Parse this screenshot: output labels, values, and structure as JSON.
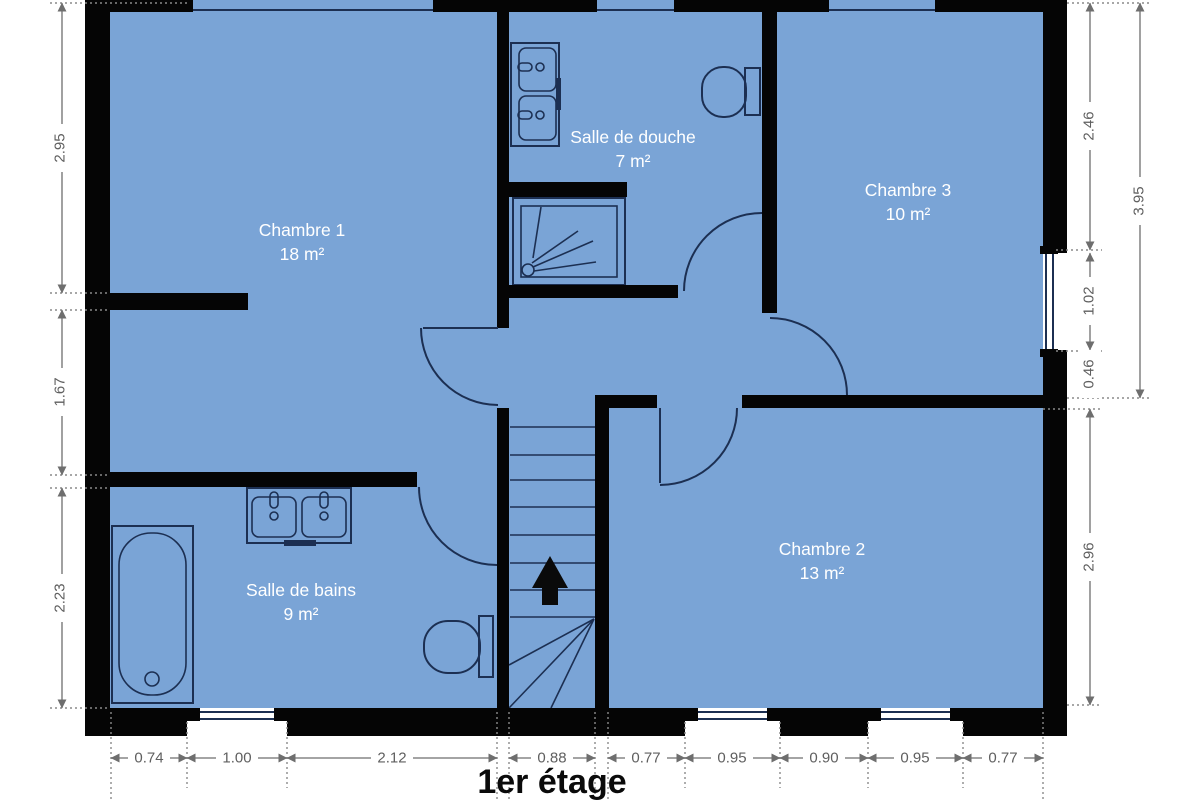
{
  "title": "1er étage",
  "rooms": {
    "chambre1": {
      "name": "Chambre 1",
      "area": "18 m²"
    },
    "salle_douche": {
      "name": "Salle de douche",
      "area": "7 m²"
    },
    "chambre3": {
      "name": "Chambre 3",
      "area": "10 m²"
    },
    "chambre2": {
      "name": "Chambre 2",
      "area": "13 m²"
    },
    "salle_bains": {
      "name": "Salle de bains",
      "area": "9 m²"
    }
  },
  "dims": {
    "left": [
      "2.95",
      "1.67",
      "2.23"
    ],
    "right": [
      "2.46",
      "1.02",
      "0.46",
      "2.96"
    ],
    "right_overall": "3.95",
    "bottom": [
      "0.74",
      "1.00",
      "2.12",
      "0.88",
      "0.77",
      "0.95",
      "0.90",
      "0.95",
      "0.77"
    ]
  },
  "icons": {
    "stairs_direction": "up-arrow"
  },
  "colors": {
    "floor": "#7aa4d6",
    "wall": "#050505",
    "fixture_outline": "#1c2f52",
    "dimension": "#6e6e6e",
    "room_label": "#ffffff",
    "title": "#0a0a0a"
  }
}
